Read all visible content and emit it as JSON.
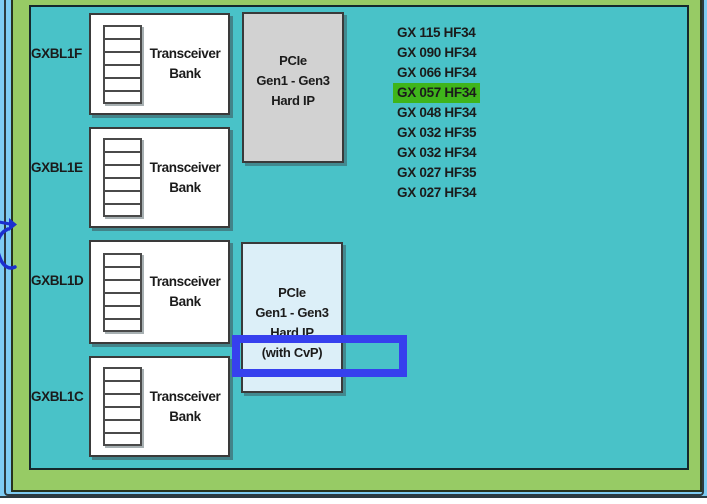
{
  "banks": [
    {
      "label": "GXBL1F"
    },
    {
      "label": "GXBL1E"
    },
    {
      "label": "GXBL1D"
    },
    {
      "label": "GXBL1C"
    }
  ],
  "bank_box": {
    "line1": "Transceiver",
    "line2": "Bank"
  },
  "pcie_top_block": {
    "lines": [
      "PCIe",
      "Gen1 - Gen3",
      "Hard IP"
    ]
  },
  "pcie_cvp_block": {
    "lines": [
      "PCIe",
      "Gen1 - Gen3",
      "Hard IP",
      "(with CvP)"
    ]
  },
  "device_list": {
    "items": [
      "GX 115 HF34",
      "GX 090 HF34",
      "GX 066 HF34",
      "GX 057 HF34",
      "GX 048 HF34",
      "GX 032 HF35",
      "GX 032 HF34",
      "GX 027 HF35",
      "GX 027 HF34"
    ],
    "highlighted_item": "GX 057 HF34",
    "highlighted_index": 3
  },
  "colors": {
    "teal_region": "#49C2C8",
    "green_frame": "#97CB65",
    "page_blue": "#7ECBF2",
    "pcie_gray_fill": "#D2D2D2",
    "pcie_cvp_fill": "#DCEFF8",
    "highlight_green": "#3FB51B",
    "annotation_blue": "#3640EE",
    "doodle_blue": "#1B2ECF",
    "text_color": "#1B1B1B"
  }
}
